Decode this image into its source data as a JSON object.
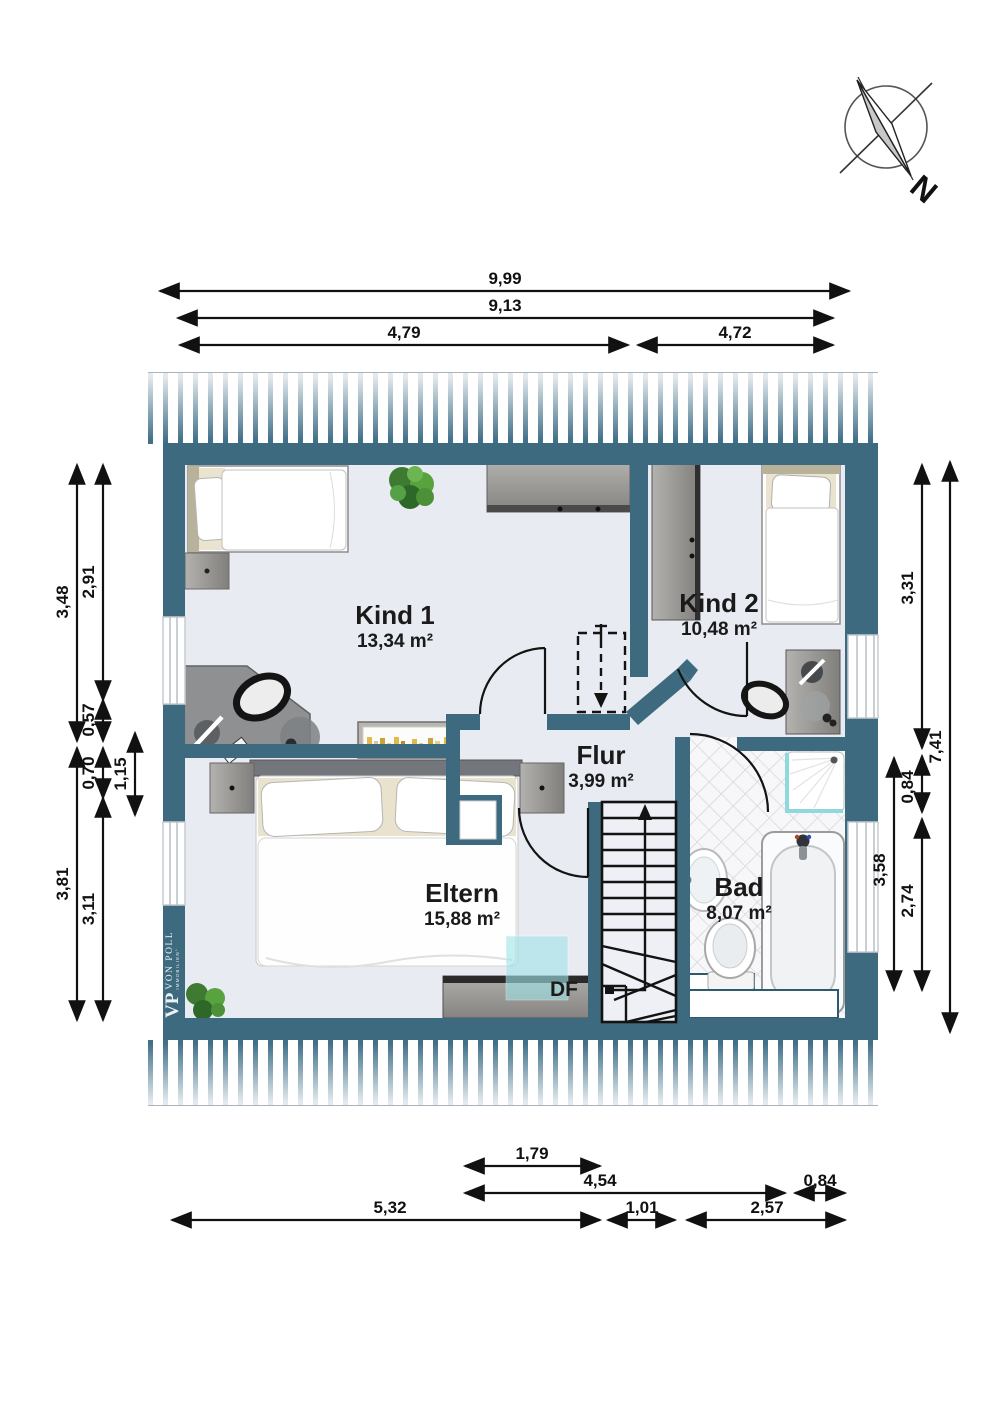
{
  "compass": {
    "label": "N"
  },
  "logo": {
    "vp": "VP",
    "line1": "VON POLL",
    "line2": "IMMOBILIEN°"
  },
  "skylight_label": "DF",
  "rooms": [
    {
      "name": "Kind 1",
      "area": "13,34 m²"
    },
    {
      "name": "Kind 2",
      "area": "10,48 m²"
    },
    {
      "name": "Flur",
      "area": "3,99 m²"
    },
    {
      "name": "Eltern",
      "area": "15,88 m²"
    },
    {
      "name": "Bad",
      "area": "8,07 m²"
    }
  ],
  "dimensions": {
    "top": [
      "9,99",
      "9,13",
      "4,79",
      "4,72"
    ],
    "left": [
      "3,48",
      "2,91",
      "0,57",
      "0,70",
      "1,15",
      "3,81",
      "3,11"
    ],
    "right": [
      "3,31",
      "7,41",
      "0,84",
      "3,58",
      "2,74"
    ],
    "bottom": [
      "1,79",
      "4,54",
      "0,84",
      "5,32",
      "1,01",
      "2,57"
    ]
  },
  "colors": {
    "wall": "#3d6a7e",
    "floor": "#e9ebf2",
    "glass": "#9fe4e8",
    "hatch": "#41708a"
  }
}
